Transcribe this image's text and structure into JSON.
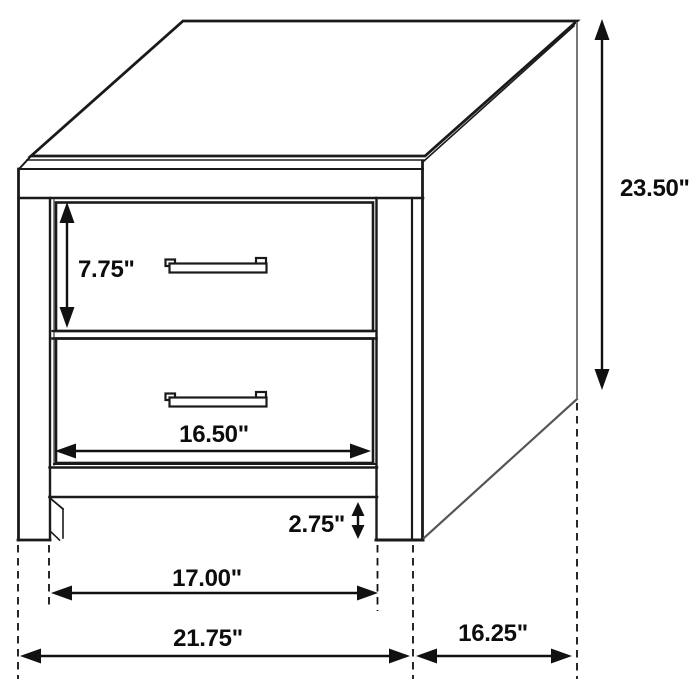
{
  "diagram": {
    "subject": "2-drawer nightstand",
    "style": "technical dimension line drawing",
    "background_color": "#ffffff",
    "line_color": "#1a1a1a",
    "drawer_count": 2,
    "handle_type": "bar-pull"
  },
  "dimensions": {
    "overall_height": {
      "label": "23.50\"",
      "value": 23.5,
      "unit": "inches"
    },
    "top_drawer_height": {
      "label": "7.75\"",
      "value": 7.75,
      "unit": "inches"
    },
    "drawer_width": {
      "label": "16.50\"",
      "value": 16.5,
      "unit": "inches"
    },
    "base_clearance": {
      "label": "2.75\"",
      "value": 2.75,
      "unit": "inches"
    },
    "between_legs_width": {
      "label": "17.00\"",
      "value": 17.0,
      "unit": "inches"
    },
    "overall_width": {
      "label": "21.75\"",
      "value": 21.75,
      "unit": "inches"
    },
    "overall_depth": {
      "label": "16.25\"",
      "value": 16.25,
      "unit": "inches"
    }
  }
}
